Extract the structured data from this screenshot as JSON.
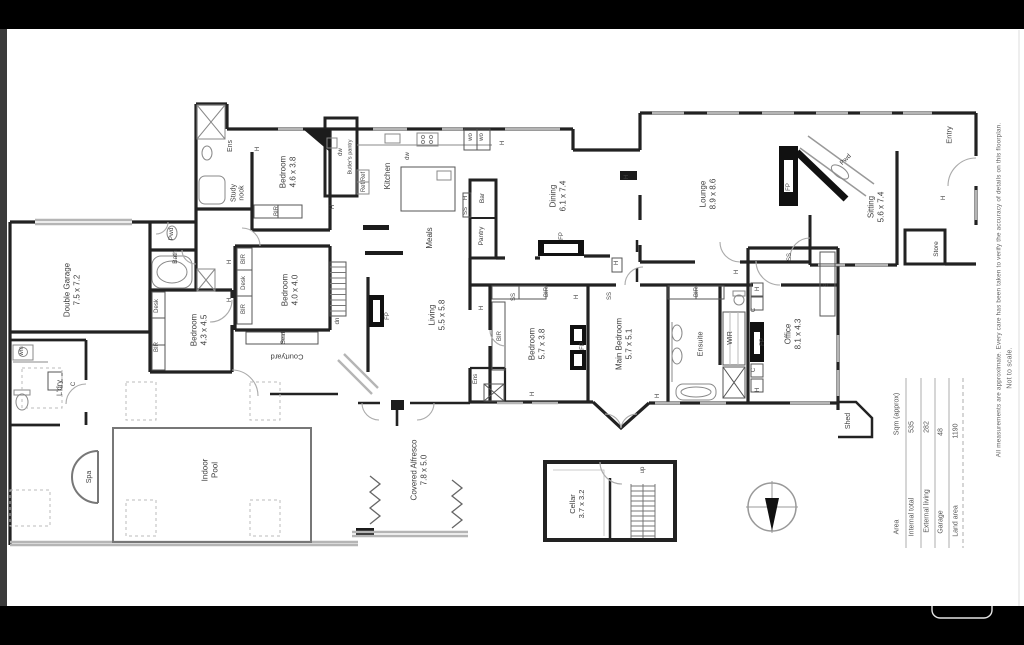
{
  "window": {
    "bg": "#000000",
    "paper": "#ffffff",
    "left_strip": "#3b3b3b"
  },
  "plan": {
    "rooms": [
      {
        "name": "Double Garage",
        "dims": "7.5 x 7.2"
      },
      {
        "name": "Ens",
        "dims": ""
      },
      {
        "name": "Study nook",
        "dims": ""
      },
      {
        "name": "Bedroom",
        "dims": "4.6 x 3.8"
      },
      {
        "name": "Pwd",
        "dims": ""
      },
      {
        "name": "Bath",
        "dims": ""
      },
      {
        "name": "Bedroom",
        "dims": "4.3 x 4.5"
      },
      {
        "name": "Bedroom",
        "dims": "4.0 x 4.0"
      },
      {
        "name": "Courtyard",
        "dims": ""
      },
      {
        "name": "Living",
        "dims": "5.5 x 5.8"
      },
      {
        "name": "Kitchen",
        "dims": ""
      },
      {
        "name": "Meals",
        "dims": ""
      },
      {
        "name": "Butler's pantry",
        "dims": ""
      },
      {
        "name": "Bar",
        "dims": ""
      },
      {
        "name": "Pantry",
        "dims": ""
      },
      {
        "name": "Dining",
        "dims": "6.1 x 7.4"
      },
      {
        "name": "Lounge",
        "dims": "8.9 x 8.6"
      },
      {
        "name": "Pwd",
        "dims": ""
      },
      {
        "name": "Sitting",
        "dims": "5.6 x 7.4"
      },
      {
        "name": "Entry",
        "dims": ""
      },
      {
        "name": "Store",
        "dims": ""
      },
      {
        "name": "Bedroom",
        "dims": "5.7 x 3.8"
      },
      {
        "name": "Main Bedroom",
        "dims": "5.7 x 5.1"
      },
      {
        "name": "Ensuite",
        "dims": ""
      },
      {
        "name": "WIR",
        "dims": ""
      },
      {
        "name": "Office",
        "dims": "8.1 x 4.3"
      },
      {
        "name": "Shed",
        "dims": ""
      },
      {
        "name": "L'dry",
        "dims": ""
      },
      {
        "name": "Spa",
        "dims": ""
      },
      {
        "name": "Indoor Pool",
        "dims": ""
      },
      {
        "name": "Covered Alfresco",
        "dims": "7.8 x 5.0"
      },
      {
        "name": "Cellar",
        "dims": "3.7 x 3.2"
      }
    ],
    "markers": [
      "Desk",
      "BIR",
      "BIR",
      "Desk",
      "BIR",
      "H",
      "H",
      "BIR",
      "dn",
      "Seat",
      "FP",
      "dw",
      "dw",
      "Ref/Ref",
      "wo",
      "wo",
      "H",
      "H",
      "SS",
      "FP",
      "H",
      "H",
      "FP",
      "H",
      "BIR",
      "BIR",
      "SS",
      "SS",
      "H",
      "FP",
      "BIR",
      "H",
      "H",
      "H",
      "H",
      "FP",
      "H",
      "C",
      "C",
      "H",
      "S",
      "SS",
      "wm",
      "C",
      "up",
      "Ens",
      "H",
      "H"
    ]
  },
  "area_table": {
    "rows": [
      {
        "label": "Area",
        "value": "Sqm (approx)"
      },
      {
        "label": "Internal total",
        "value": "535"
      },
      {
        "label": "External living",
        "value": "282"
      },
      {
        "label": "Garage",
        "value": "48"
      },
      {
        "label": "Land area",
        "value": "1190"
      }
    ]
  },
  "notes": {
    "disclaimer": "All measurements are approximate. Every care has been taken to verify the accuracy of details on this floorplan.",
    "scale": "Not to scale."
  }
}
